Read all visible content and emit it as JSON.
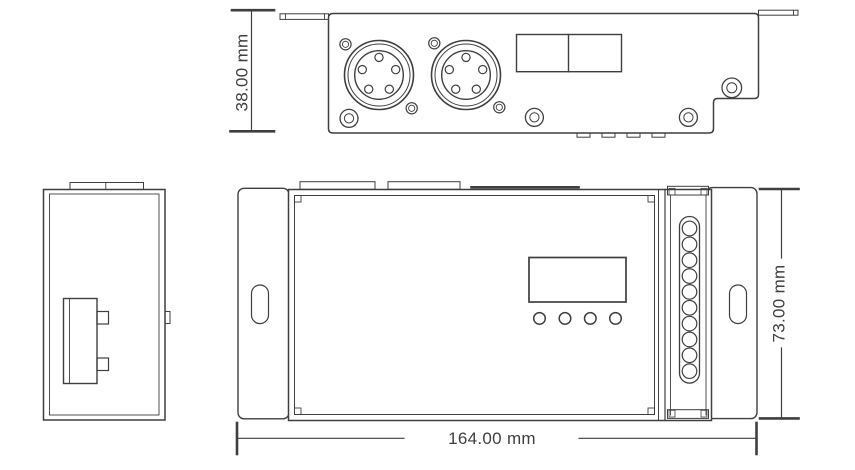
{
  "page": {
    "background": "#ffffff"
  },
  "drawing": {
    "type": "mechanical-dimension-drawing",
    "units": "mm",
    "line_color": "#3f3f3f",
    "text_color": "#3f3f3f",
    "labels": {
      "front_height": "38.00 mm",
      "top_height": "73.00 mm",
      "top_length": "164.00 mm"
    },
    "views": {
      "front_view": {
        "xlr_connectors": 2,
        "pins_per_connector": 5,
        "switch_block_cells": 2,
        "panel_screws": 4,
        "small_holes": 4,
        "bottom_tabs": 4
      },
      "side_view": {
        "mounting_clip": 1,
        "top_tabs": 2
      },
      "top_view": {
        "display_window": 1,
        "buttons": 4,
        "terminal_holes": 10,
        "mounting_slots": 2,
        "top_tabs": 2
      }
    }
  }
}
